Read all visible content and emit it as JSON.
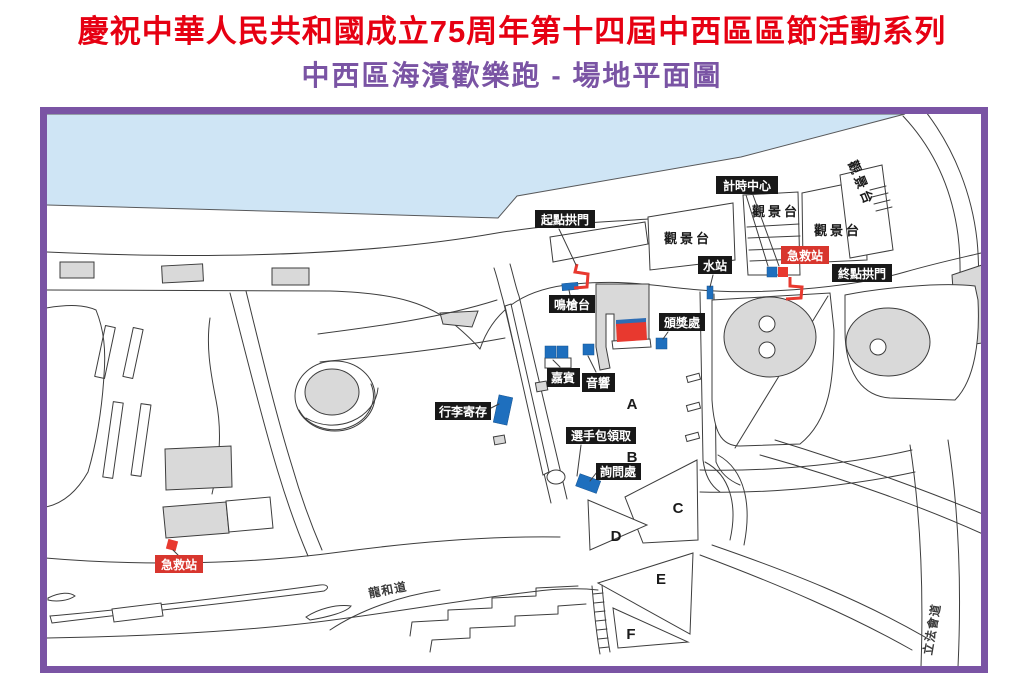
{
  "header": {
    "title_line1": "慶祝中華人民共和國成立75周年第十四屆中西區區節活動系列",
    "title_line2": "中西區海濱歡樂跑 - 場地平面圖"
  },
  "colors": {
    "title_red": "#e60012",
    "frame_purple": "#7a54a4",
    "water_blue": "#cfe5f5",
    "building_gray": "#d9d9d9",
    "station_blue": "#1e6fbe",
    "route_red": "#e8392f",
    "first_aid_red": "#d8362e",
    "label_black": "#181818"
  },
  "map": {
    "labels": {
      "start_arch": "起點拱門",
      "timing_center": "計時中心",
      "viewing_platform": "觀景台",
      "water_station": "水站",
      "first_aid": "急救站",
      "finish_arch": "終點拱門",
      "firing_platform": "鳴槍台",
      "prize_area": "頒獎處",
      "guests": "嘉賓",
      "audio": "音響",
      "baggage_storage": "行李寄存",
      "runner_pack_pickup": "選手包領取",
      "inquiry_desk": "詢問處"
    },
    "zones": [
      "A",
      "B",
      "C",
      "D",
      "E",
      "F"
    ],
    "roads": {
      "lung_wo_road": "龍和道",
      "legco_road": "立法會道"
    }
  }
}
